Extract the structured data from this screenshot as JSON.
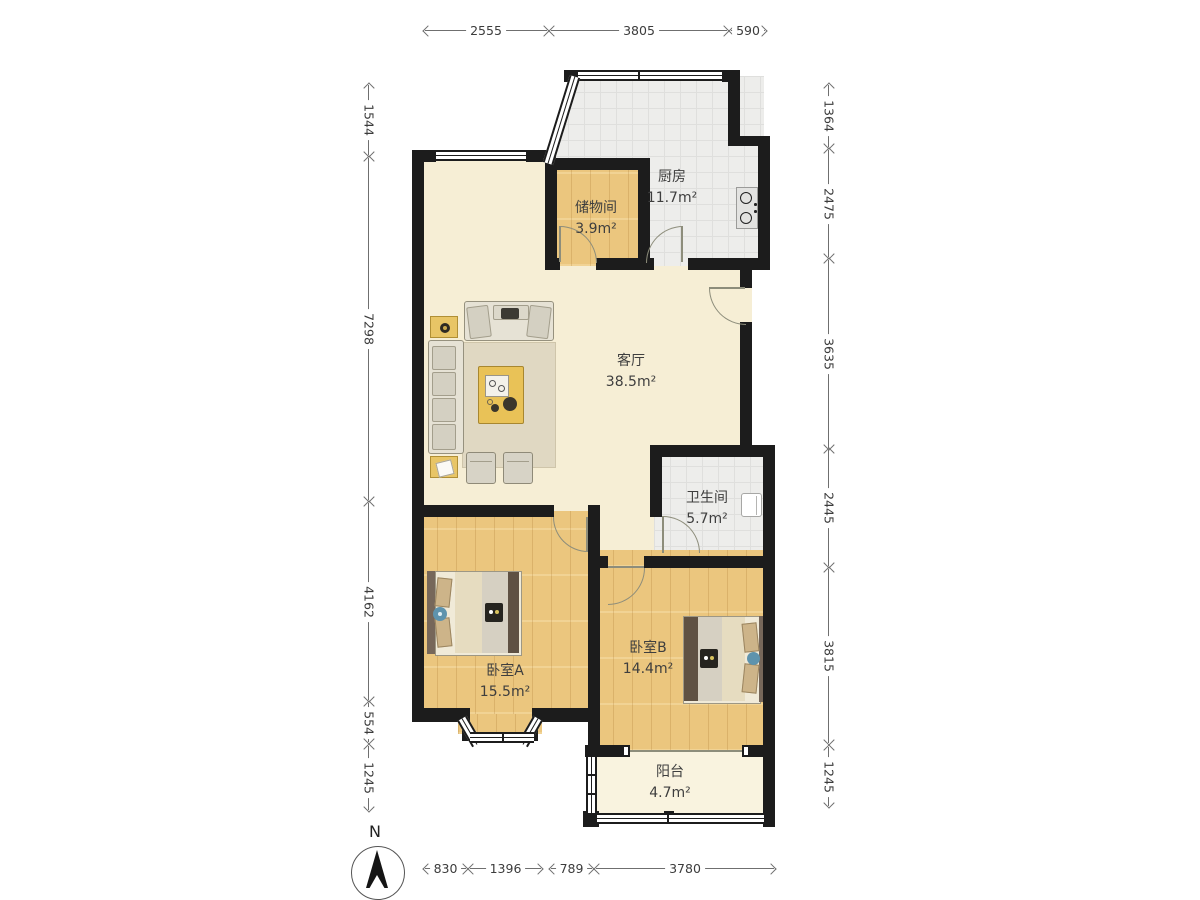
{
  "plan": {
    "title": "两室一厅户型图",
    "rooms": [
      {
        "id": "living",
        "name": "客厅",
        "area": "38.5m²"
      },
      {
        "id": "kitchen",
        "name": "厨房",
        "area": "11.7m²"
      },
      {
        "id": "storage",
        "name": "储物间",
        "area": "3.9m²"
      },
      {
        "id": "bathroom",
        "name": "卫生间",
        "area": "5.7m²"
      },
      {
        "id": "bedroomA",
        "name": "卧室A",
        "area": "15.5m²"
      },
      {
        "id": "bedroomB",
        "name": "卧室B",
        "area": "14.4m²"
      },
      {
        "id": "balcony",
        "name": "阳台",
        "area": "4.7m²"
      }
    ],
    "dimensions": {
      "top": [
        "2555",
        "3805",
        "590"
      ],
      "bottom": [
        "830",
        "1396",
        "789",
        "3780"
      ],
      "left": [
        "1544",
        "7298",
        "4162",
        "554",
        "1245"
      ],
      "right": [
        "1364",
        "2475",
        "3635",
        "2445",
        "3815",
        "1245"
      ]
    },
    "compass": {
      "label": "N"
    },
    "colors": {
      "wall": "#1c1c1c",
      "wood_floor": "#ebc67e",
      "tile_floor": "#ededeb",
      "living_floor": "#f6eed5",
      "balcony_floor": "#f9f3df",
      "dimension_line": "#6f6f6f"
    }
  }
}
